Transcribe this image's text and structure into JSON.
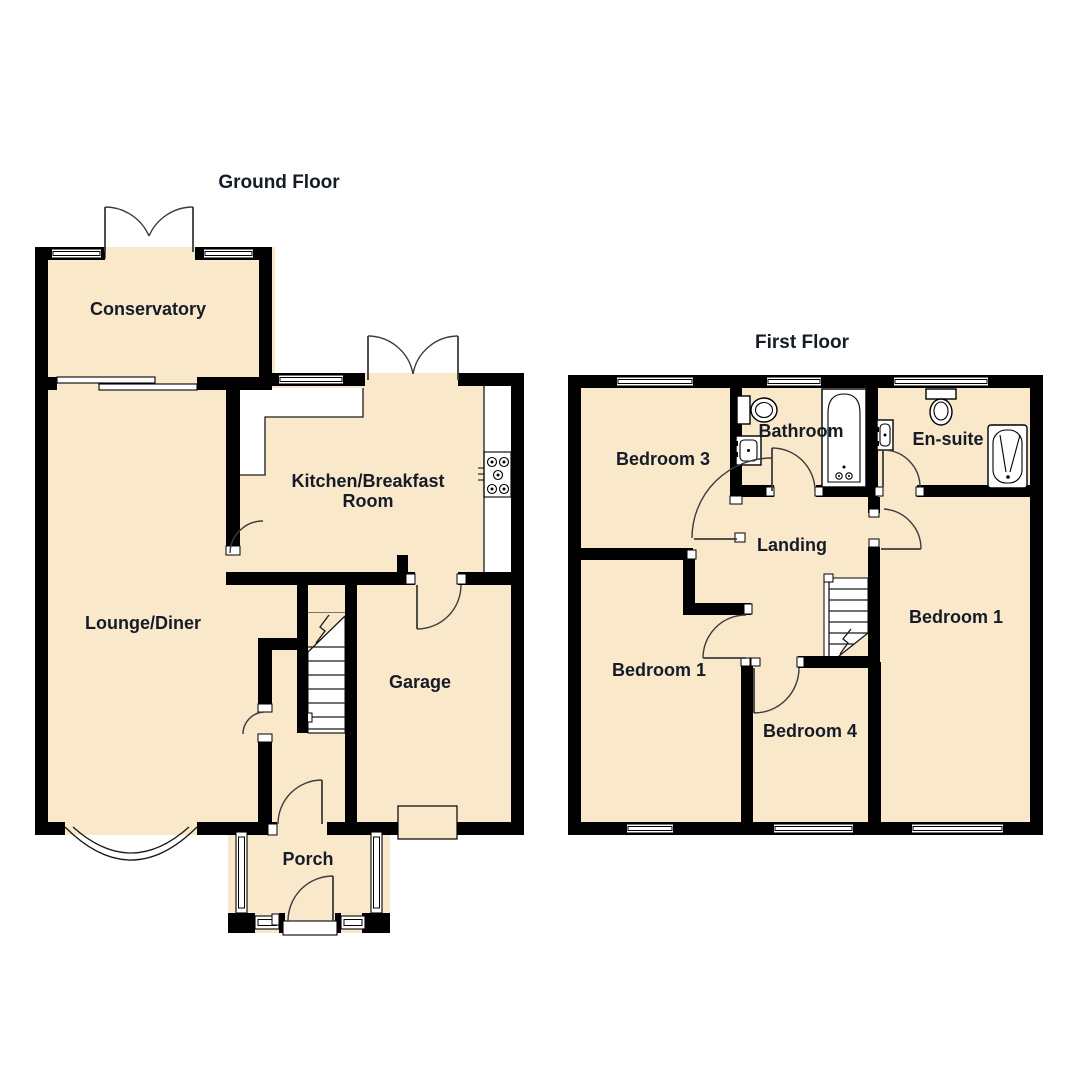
{
  "titles": {
    "ground_floor": "Ground Floor",
    "first_floor": "First Floor"
  },
  "ground_floor": {
    "rooms": {
      "conservatory": "Conservatory",
      "kitchen_line1": "Kitchen/Breakfast",
      "kitchen_line2": "Room",
      "lounge": "Lounge/Diner",
      "garage": "Garage",
      "porch": "Porch"
    }
  },
  "first_floor": {
    "rooms": {
      "bedroom3": "Bedroom 3",
      "bathroom": "Bathroom",
      "ensuite": "En-suite",
      "landing": "Landing",
      "bedroom1_left": "Bedroom 1",
      "bedroom4": "Bedroom 4",
      "bedroom1_right": "Bedroom 1"
    }
  },
  "fixtures": [
    "staircase-icon",
    "bathtub-icon",
    "toilet-icon",
    "sink-icon",
    "shower-icon",
    "hob-icon",
    "bay-window-icon",
    "garage-door-icon"
  ],
  "colors": {
    "room_fill": "#FAE8CB",
    "wall": "#000000",
    "line": "#1A1A1A",
    "text": "#151C28",
    "background": "#FFFFFF"
  }
}
